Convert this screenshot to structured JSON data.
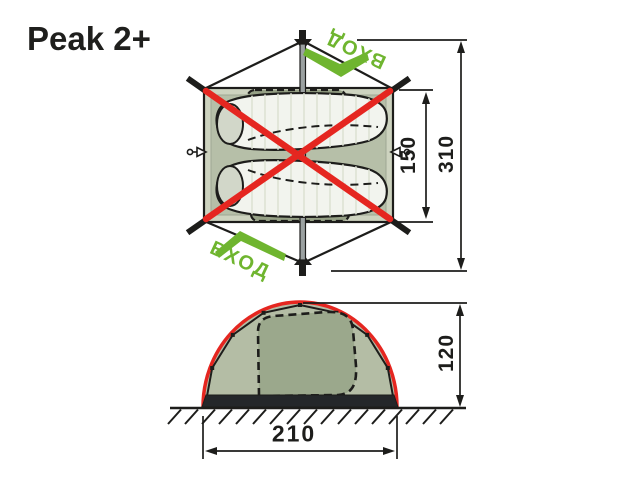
{
  "title": "Peak 2+",
  "top_view": {
    "entrance_top": "ВХОД",
    "entrance_bottom": "ВХОД",
    "dim_inner": "150",
    "dim_outer": "310"
  },
  "side_view": {
    "dim_height": "120",
    "dim_width": "210"
  },
  "colors": {
    "ink": "#1d1d1b",
    "pole_red": "#e52620",
    "entrance_green": "#6fb52f",
    "fabric_sage": "#b6bfa8",
    "fabric_sage_light": "#cdd3bf",
    "fabric_sage_dark": "#96a186"
  }
}
